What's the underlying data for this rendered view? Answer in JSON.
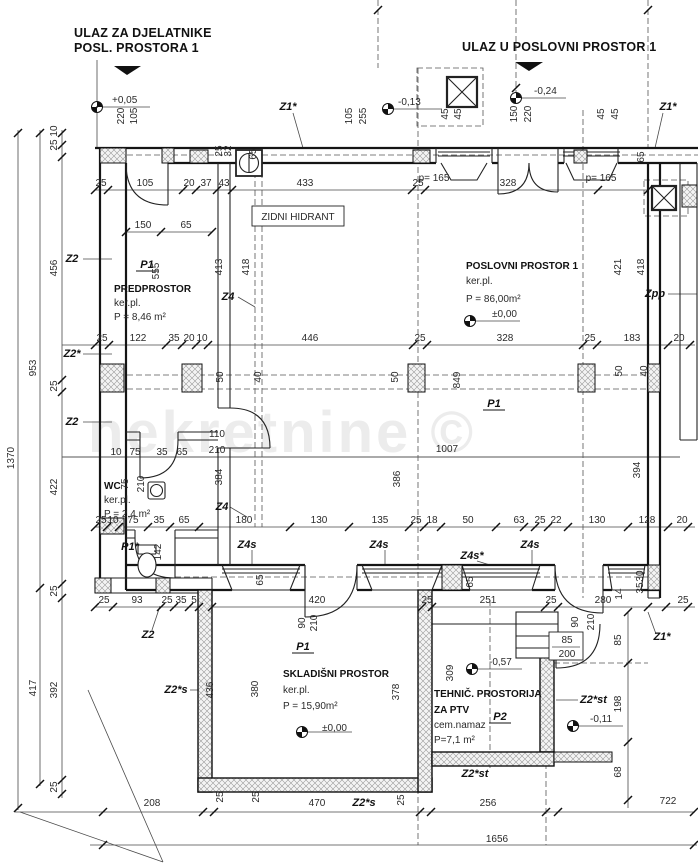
{
  "watermark": "nekretnine ©",
  "entrances": [
    {
      "line1": "ULAZ ZA DJELATNIKE",
      "line2": "POSL. PROSTORA 1"
    },
    {
      "line1": "ULAZ U POSLOVNI PROSTOR 1"
    }
  ],
  "labels": [
    {
      "t": "+0,05",
      "x": 112,
      "y": 103,
      "a": "s",
      "n": "elevation-label"
    },
    {
      "t": "220",
      "x": 124,
      "y": 116,
      "r": 1
    },
    {
      "t": "105",
      "x": 137,
      "y": 116,
      "r": 1
    },
    {
      "t": "Z1*",
      "x": 288,
      "y": 110,
      "b": 1,
      "n": "wall-tag"
    },
    {
      "t": "105",
      "x": 352,
      "y": 116,
      "r": 1
    },
    {
      "t": "255",
      "x": 366,
      "y": 116,
      "r": 1
    },
    {
      "t": "-0,13",
      "x": 398,
      "y": 105,
      "a": "s",
      "n": "elevation-label"
    },
    {
      "t": "45",
      "x": 448,
      "y": 114,
      "r": 1
    },
    {
      "t": "45",
      "x": 461,
      "y": 114,
      "r": 1
    },
    {
      "t": "150",
      "x": 517,
      "y": 114,
      "r": 1
    },
    {
      "t": "220",
      "x": 531,
      "y": 114,
      "r": 1
    },
    {
      "t": "-0,24",
      "x": 534,
      "y": 94,
      "a": "s",
      "n": "elevation-label"
    },
    {
      "t": "45",
      "x": 604,
      "y": 114,
      "r": 1
    },
    {
      "t": "45",
      "x": 618,
      "y": 114,
      "r": 1
    },
    {
      "t": "Z1*",
      "x": 668,
      "y": 110,
      "b": 1,
      "n": "wall-tag"
    },
    {
      "t": "25",
      "x": 222,
      "y": 151,
      "r": 1,
      "f": 8.5
    },
    {
      "t": "32",
      "x": 231,
      "y": 151,
      "r": 1,
      "f": 8.5
    },
    {
      "t": "65",
      "x": 256,
      "y": 154,
      "r": 1
    },
    {
      "t": "65",
      "x": 644,
      "y": 157,
      "r": 1
    },
    {
      "t": "p= 165",
      "x": 434,
      "y": 181,
      "f": 9.5
    },
    {
      "t": "p= 165",
      "x": 601,
      "y": 181,
      "f": 9.5
    },
    {
      "t": "25",
      "x": 101,
      "y": 186
    },
    {
      "t": "105",
      "x": 145,
      "y": 186
    },
    {
      "t": "20",
      "x": 189,
      "y": 186
    },
    {
      "t": "37",
      "x": 206,
      "y": 186
    },
    {
      "t": "43",
      "x": 224,
      "y": 186
    },
    {
      "t": "433",
      "x": 305,
      "y": 186
    },
    {
      "t": "25",
      "x": 418,
      "y": 186
    },
    {
      "t": "328",
      "x": 508,
      "y": 186
    },
    {
      "t": "ZIDNI HIDRANT",
      "x": 298,
      "y": 220,
      "f": 9,
      "n": "hydrant-label"
    },
    {
      "t": "150",
      "x": 143,
      "y": 228
    },
    {
      "t": "65",
      "x": 186,
      "y": 228
    },
    {
      "t": "1370",
      "x": 14,
      "y": 458,
      "r": 1
    },
    {
      "t": "953",
      "x": 36,
      "y": 368,
      "r": 1
    },
    {
      "t": "417",
      "x": 36,
      "y": 688,
      "r": 1
    },
    {
      "t": "10",
      "x": 57,
      "y": 131,
      "r": 1,
      "f": 8.5
    },
    {
      "t": "25",
      "x": 57,
      "y": 145,
      "r": 1,
      "f": 8.5
    },
    {
      "t": "456",
      "x": 57,
      "y": 268,
      "r": 1
    },
    {
      "t": "25",
      "x": 57,
      "y": 386,
      "r": 1
    },
    {
      "t": "422",
      "x": 57,
      "y": 487,
      "r": 1
    },
    {
      "t": "25",
      "x": 57,
      "y": 591,
      "r": 1
    },
    {
      "t": "392",
      "x": 57,
      "y": 690,
      "r": 1
    },
    {
      "t": "25",
      "x": 57,
      "y": 787,
      "r": 1
    },
    {
      "t": "Z2",
      "x": 72,
      "y": 262,
      "b": 1,
      "n": "wall-tag"
    },
    {
      "t": "Z2*",
      "x": 72,
      "y": 357,
      "b": 1,
      "n": "wall-tag"
    },
    {
      "t": "Z2",
      "x": 72,
      "y": 425,
      "b": 1,
      "n": "wall-tag"
    },
    {
      "t": "P1",
      "x": 147,
      "y": 268,
      "b": 1,
      "u": 1,
      "n": "room-tag"
    },
    {
      "t": "555",
      "x": 159,
      "y": 271,
      "r": 1
    },
    {
      "t": "PREDPROSTOR",
      "x": 114,
      "y": 292,
      "a": "s",
      "f": 10.5,
      "m": 1,
      "n": "room-name"
    },
    {
      "t": "ker.pl.",
      "x": 114,
      "y": 306,
      "a": "s",
      "n": "room-finish"
    },
    {
      "t": "P = 8,46 m²",
      "x": 114,
      "y": 320,
      "a": "s",
      "n": "room-area"
    },
    {
      "t": "413",
      "x": 222,
      "y": 267,
      "r": 1
    },
    {
      "t": "418",
      "x": 249,
      "y": 267,
      "r": 1
    },
    {
      "t": "Z4",
      "x": 228,
      "y": 300,
      "b": 1,
      "n": "wall-tag"
    },
    {
      "t": "POSLOVNI PROSTOR 1",
      "x": 466,
      "y": 269,
      "a": "s",
      "f": 10.5,
      "m": 1,
      "n": "room-name"
    },
    {
      "t": "ker.pl.",
      "x": 466,
      "y": 284,
      "a": "s",
      "n": "room-finish"
    },
    {
      "t": "P = 86,00m²",
      "x": 466,
      "y": 302,
      "a": "s",
      "n": "room-area"
    },
    {
      "t": "±0,00",
      "x": 492,
      "y": 317,
      "a": "s",
      "n": "elevation-label"
    },
    {
      "t": "421",
      "x": 621,
      "y": 267,
      "r": 1
    },
    {
      "t": "418",
      "x": 644,
      "y": 267,
      "r": 1
    },
    {
      "t": "Zpp",
      "x": 655,
      "y": 297,
      "b": 1,
      "n": "wall-tag"
    },
    {
      "t": "25",
      "x": 102,
      "y": 341
    },
    {
      "t": "122",
      "x": 138,
      "y": 341
    },
    {
      "t": "35",
      "x": 174,
      "y": 341
    },
    {
      "t": "20",
      "x": 189,
      "y": 341
    },
    {
      "t": "10",
      "x": 202,
      "y": 341
    },
    {
      "t": "446",
      "x": 310,
      "y": 341
    },
    {
      "t": "25",
      "x": 420,
      "y": 341
    },
    {
      "t": "328",
      "x": 505,
      "y": 341
    },
    {
      "t": "25",
      "x": 590,
      "y": 341
    },
    {
      "t": "183",
      "x": 632,
      "y": 341
    },
    {
      "t": "20",
      "x": 679,
      "y": 341
    },
    {
      "t": "50",
      "x": 223,
      "y": 377,
      "r": 1
    },
    {
      "t": "40",
      "x": 261,
      "y": 377,
      "r": 1
    },
    {
      "t": "50",
      "x": 398,
      "y": 377,
      "r": 1
    },
    {
      "t": "50",
      "x": 622,
      "y": 371,
      "r": 1
    },
    {
      "t": "40",
      "x": 647,
      "y": 371,
      "r": 1
    },
    {
      "t": "849",
      "x": 460,
      "y": 380,
      "r": 1
    },
    {
      "t": "P1",
      "x": 494,
      "y": 407,
      "b": 1,
      "u": 1,
      "n": "room-tag"
    },
    {
      "t": "1007",
      "x": 447,
      "y": 452
    },
    {
      "t": "386",
      "x": 400,
      "y": 479,
      "r": 1
    },
    {
      "t": "384",
      "x": 222,
      "y": 477,
      "r": 1
    },
    {
      "t": "394",
      "x": 640,
      "y": 470,
      "r": 1
    },
    {
      "t": "110",
      "x": 217,
      "y": 437,
      "n": "door-size"
    },
    {
      "t": "210",
      "x": 217,
      "y": 453,
      "n": "door-size"
    },
    {
      "t": "10",
      "x": 116,
      "y": 455
    },
    {
      "t": "75",
      "x": 135,
      "y": 455
    },
    {
      "t": "35",
      "x": 162,
      "y": 455
    },
    {
      "t": "65",
      "x": 182,
      "y": 455
    },
    {
      "t": "WC",
      "x": 104,
      "y": 489,
      "a": "s",
      "f": 10.5,
      "m": 1,
      "n": "room-name"
    },
    {
      "t": "ker.pl.",
      "x": 104,
      "y": 503,
      "a": "s",
      "n": "room-finish"
    },
    {
      "t": "P = 2,4 m²",
      "x": 104,
      "y": 517,
      "a": "s",
      "n": "room-area"
    },
    {
      "t": "75",
      "x": 128,
      "y": 484,
      "r": 1,
      "n": "door-size"
    },
    {
      "t": "210",
      "x": 144,
      "y": 484,
      "r": 1,
      "n": "door-size"
    },
    {
      "t": "Z4",
      "x": 222,
      "y": 510,
      "b": 1,
      "n": "wall-tag"
    },
    {
      "t": "P1*",
      "x": 130,
      "y": 550,
      "b": 1,
      "n": "room-tag"
    },
    {
      "t": "142",
      "x": 161,
      "y": 552,
      "r": 1
    },
    {
      "t": "25",
      "x": 101,
      "y": 523
    },
    {
      "t": "10",
      "x": 113,
      "y": 523
    },
    {
      "t": "75",
      "x": 133,
      "y": 523
    },
    {
      "t": "35",
      "x": 159,
      "y": 523
    },
    {
      "t": "65",
      "x": 184,
      "y": 523
    },
    {
      "t": "180",
      "x": 244,
      "y": 523
    },
    {
      "t": "130",
      "x": 319,
      "y": 523
    },
    {
      "t": "135",
      "x": 380,
      "y": 523
    },
    {
      "t": "25",
      "x": 416,
      "y": 523
    },
    {
      "t": "18",
      "x": 432,
      "y": 523
    },
    {
      "t": "50",
      "x": 468,
      "y": 523
    },
    {
      "t": "63",
      "x": 519,
      "y": 523
    },
    {
      "t": "25",
      "x": 540,
      "y": 523
    },
    {
      "t": "22",
      "x": 556,
      "y": 523
    },
    {
      "t": "130",
      "x": 597,
      "y": 523
    },
    {
      "t": "128",
      "x": 647,
      "y": 523
    },
    {
      "t": "20",
      "x": 682,
      "y": 523
    },
    {
      "t": "Z4s",
      "x": 247,
      "y": 548,
      "b": 1,
      "n": "wall-tag"
    },
    {
      "t": "Z4s",
      "x": 379,
      "y": 548,
      "b": 1,
      "n": "wall-tag"
    },
    {
      "t": "Z4s*",
      "x": 472,
      "y": 559,
      "b": 1,
      "n": "wall-tag"
    },
    {
      "t": "Z4s",
      "x": 530,
      "y": 548,
      "b": 1,
      "n": "wall-tag"
    },
    {
      "t": "65",
      "x": 263,
      "y": 580,
      "r": 1
    },
    {
      "t": "65",
      "x": 473,
      "y": 582,
      "r": 1
    },
    {
      "t": "30",
      "x": 643,
      "y": 576,
      "r": 1,
      "f": 8.5
    },
    {
      "t": "35",
      "x": 643,
      "y": 588,
      "r": 1,
      "f": 8.5
    },
    {
      "t": "14",
      "x": 622,
      "y": 594,
      "r": 1,
      "f": 8.5
    },
    {
      "t": "25",
      "x": 104,
      "y": 603
    },
    {
      "t": "93",
      "x": 137,
      "y": 603
    },
    {
      "t": "25",
      "x": 167,
      "y": 603
    },
    {
      "t": "35",
      "x": 181,
      "y": 603
    },
    {
      "t": "5",
      "x": 194,
      "y": 603,
      "f": 8.5
    },
    {
      "t": "420",
      "x": 317,
      "y": 603
    },
    {
      "t": "25",
      "x": 427,
      "y": 603
    },
    {
      "t": "251",
      "x": 488,
      "y": 603
    },
    {
      "t": "25",
      "x": 551,
      "y": 603
    },
    {
      "t": "280",
      "x": 603,
      "y": 603
    },
    {
      "t": "25",
      "x": 683,
      "y": 603
    },
    {
      "t": "Z2",
      "x": 148,
      "y": 638,
      "b": 1,
      "n": "wall-tag"
    },
    {
      "t": "Z1*",
      "x": 662,
      "y": 640,
      "b": 1,
      "n": "wall-tag"
    },
    {
      "t": "90",
      "x": 305,
      "y": 623,
      "r": 1,
      "f": 8.5,
      "n": "door-size"
    },
    {
      "t": "210",
      "x": 317,
      "y": 623,
      "r": 1,
      "f": 8.5,
      "n": "door-size"
    },
    {
      "t": "90",
      "x": 578,
      "y": 622,
      "r": 1,
      "f": 8.5,
      "n": "door-size"
    },
    {
      "t": "210",
      "x": 594,
      "y": 622,
      "r": 1,
      "f": 8.5,
      "n": "door-size"
    },
    {
      "t": "85",
      "x": 567,
      "y": 643,
      "f": 9.5,
      "n": "door-size"
    },
    {
      "t": "200",
      "x": 567,
      "y": 657,
      "f": 9.5,
      "n": "door-size"
    },
    {
      "t": "-0,57",
      "x": 489,
      "y": 665,
      "a": "s",
      "n": "elevation-label"
    },
    {
      "t": "309",
      "x": 453,
      "y": 673,
      "r": 1
    },
    {
      "t": "436",
      "x": 213,
      "y": 690,
      "r": 1
    },
    {
      "t": "380",
      "x": 258,
      "y": 689,
      "r": 1
    },
    {
      "t": "378",
      "x": 399,
      "y": 692,
      "r": 1
    },
    {
      "t": "P1",
      "x": 303,
      "y": 650,
      "b": 1,
      "u": 1,
      "n": "room-tag"
    },
    {
      "t": "SKLADIŠNI PROSTOR",
      "x": 283,
      "y": 677,
      "a": "s",
      "f": 10.5,
      "m": 1,
      "n": "room-name"
    },
    {
      "t": "ker.pl.",
      "x": 283,
      "y": 693,
      "a": "s",
      "n": "room-finish"
    },
    {
      "t": "P = 15,90m²",
      "x": 283,
      "y": 709,
      "a": "s",
      "n": "room-area"
    },
    {
      "t": "±0,00",
      "x": 322,
      "y": 731,
      "a": "s",
      "n": "elevation-label"
    },
    {
      "t": "Z2*s",
      "x": 176,
      "y": 693,
      "b": 1,
      "n": "wall-tag"
    },
    {
      "t": "TEHNIČ. PROSTORIJA",
      "x": 434,
      "y": 697,
      "a": "s",
      "f": 10,
      "m": 1,
      "n": "room-name"
    },
    {
      "t": "ZA PTV",
      "x": 434,
      "y": 713,
      "a": "s",
      "f": 10,
      "m": 1,
      "n": "room-name"
    },
    {
      "t": "cem.namaz",
      "x": 434,
      "y": 728,
      "a": "s",
      "n": "room-finish"
    },
    {
      "t": "P=7,1 m²",
      "x": 434,
      "y": 743,
      "a": "s",
      "n": "room-area"
    },
    {
      "t": "P2",
      "x": 500,
      "y": 720,
      "b": 1,
      "u": 1,
      "n": "room-tag"
    },
    {
      "t": "Z2*st",
      "x": 580,
      "y": 703,
      "b": 1,
      "a": "s",
      "n": "wall-tag"
    },
    {
      "t": "-0,11",
      "x": 590,
      "y": 722,
      "a": "s",
      "n": "elevation-label"
    },
    {
      "t": "Z2*st",
      "x": 475,
      "y": 777,
      "b": 1,
      "n": "wall-tag"
    },
    {
      "t": "85",
      "x": 621,
      "y": 640,
      "r": 1
    },
    {
      "t": "198",
      "x": 621,
      "y": 704,
      "r": 1
    },
    {
      "t": "68",
      "x": 621,
      "y": 772,
      "r": 1
    },
    {
      "t": "208",
      "x": 152,
      "y": 806
    },
    {
      "t": "25",
      "x": 223,
      "y": 797,
      "r": 1,
      "f": 8.5
    },
    {
      "t": "25",
      "x": 259,
      "y": 797,
      "r": 1,
      "f": 8.5
    },
    {
      "t": "470",
      "x": 317,
      "y": 806
    },
    {
      "t": "Z2*s",
      "x": 364,
      "y": 806,
      "b": 1,
      "n": "wall-tag"
    },
    {
      "t": "25",
      "x": 404,
      "y": 800,
      "r": 1,
      "f": 8.5
    },
    {
      "t": "256",
      "x": 488,
      "y": 806
    },
    {
      "t": "722",
      "x": 668,
      "y": 804
    },
    {
      "t": "1656",
      "x": 497,
      "y": 842
    }
  ]
}
